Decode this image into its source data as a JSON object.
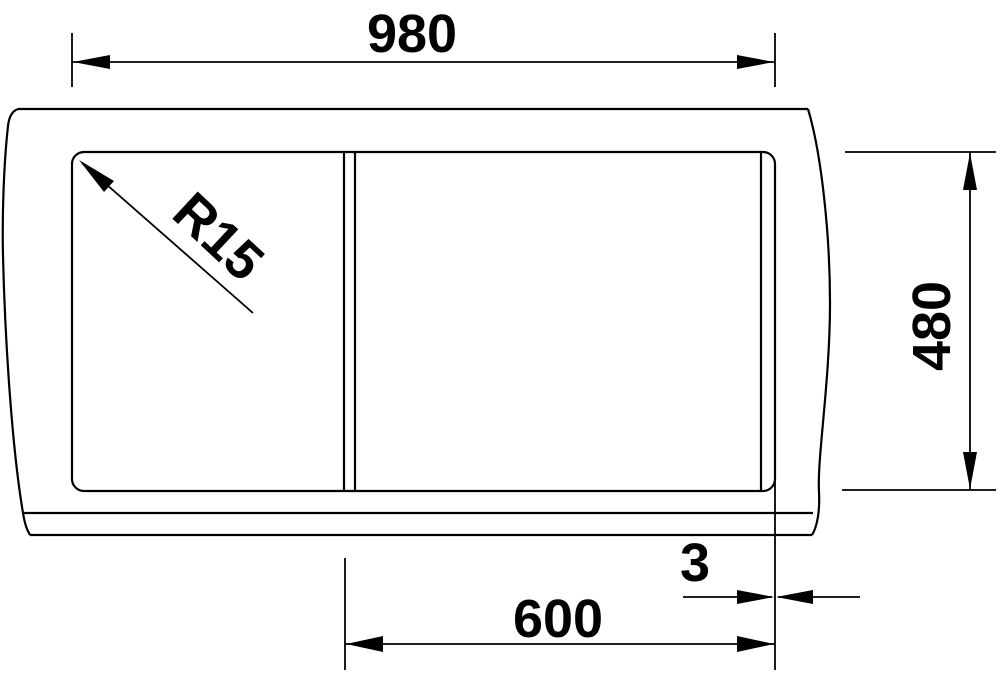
{
  "diagram": {
    "kind": "sink-installation-technical-drawing",
    "colors": {
      "line": "#000000",
      "background": "#ffffff"
    },
    "labels": {
      "overall_width": "980",
      "depth": "480",
      "cabinet_width": "600",
      "edge_offset": "3",
      "corner_radius": "R15"
    }
  }
}
